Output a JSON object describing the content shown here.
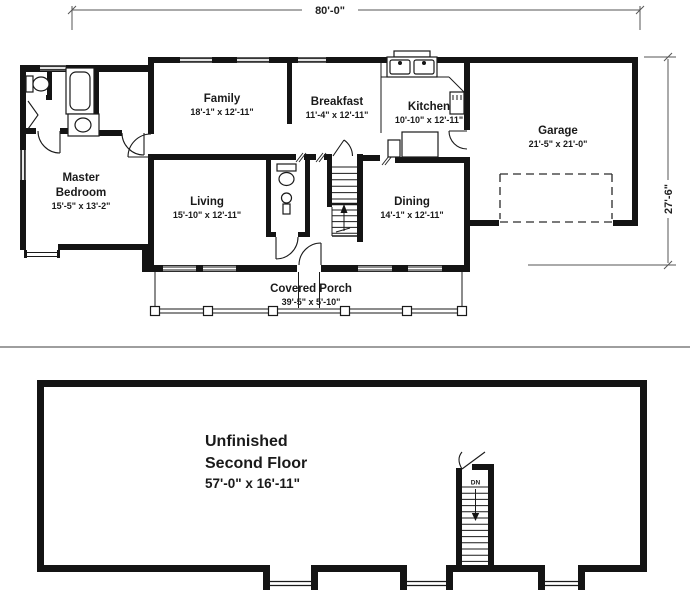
{
  "first_floor": {
    "width_dimension": "80'-0\"",
    "depth_dimension": "27'-6\"",
    "rooms": {
      "family": {
        "name": "Family",
        "size": "18'-1\" x 12'-11\""
      },
      "breakfast": {
        "name": "Breakfast",
        "size": "11'-4\" x 12'-11\""
      },
      "kitchen": {
        "name": "Kitchen",
        "size": "10'-10\" x 12'-11\""
      },
      "garage": {
        "name": "Garage",
        "size": "21'-5\" x 21'-0\""
      },
      "master_bedroom": {
        "name_line1": "Master",
        "name_line2": "Bedroom",
        "size": "15'-5\" x 13'-2\""
      },
      "living": {
        "name": "Living",
        "size": "15'-10\" x 12'-11\""
      },
      "dining": {
        "name": "Dining",
        "size": "14'-1\" x 12'-11\""
      },
      "covered_porch": {
        "name": "Covered Porch",
        "size": "39'-5\" x 5'-10\""
      }
    }
  },
  "second_floor": {
    "room": {
      "name_line1": "Unfinished",
      "name_line2": "Second Floor",
      "size": "57'-0\" x 16'-11\""
    },
    "stairs_label": "DN"
  },
  "colors": {
    "walls": "#141414",
    "background": "#ffffff",
    "divider": "#9e9e9e"
  }
}
